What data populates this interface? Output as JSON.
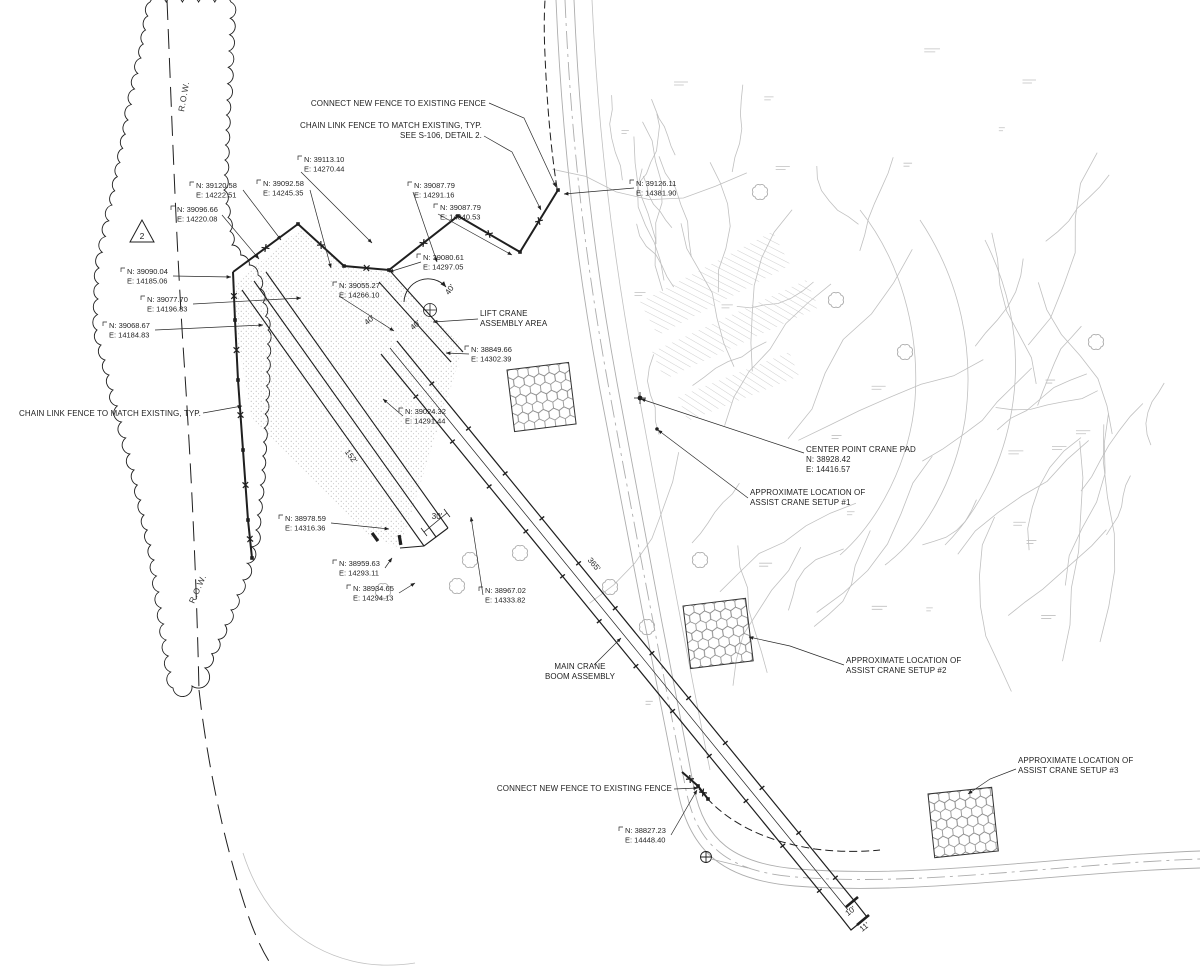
{
  "labels": {
    "connect_fence_top": "CONNECT NEW FENCE TO EXISTING FENCE",
    "chain_link_top_1": "CHAIN LINK FENCE TO MATCH EXISTING, TYP.",
    "chain_link_top_2": "SEE S-106, DETAIL 2.",
    "chain_link_left": "CHAIN LINK FENCE TO MATCH EXISTING, TYP.",
    "lift_crane_1": "LIFT CRANE",
    "lift_crane_2": "ASSEMBLY AREA",
    "center_pad_1": "CENTER POINT CRANE PAD",
    "center_pad_n": "N: 38928.42",
    "center_pad_e": "E: 14416.57",
    "assist_1_1": "APPROXIMATE LOCATION OF",
    "assist_1_2": "ASSIST CRANE SETUP #1",
    "assist_2_1": "APPROXIMATE LOCATION OF",
    "assist_2_2": "ASSIST CRANE SETUP #2",
    "assist_3_1": "APPROXIMATE LOCATION OF",
    "assist_3_2": "ASSIST CRANE SETUP #3",
    "main_crane_1": "MAIN CRANE",
    "main_crane_2": "BOOM ASSEMBLY",
    "connect_fence_bottom": "CONNECT NEW FENCE TO EXISTING FENCE",
    "row": "R.O.W.",
    "revision_triangle": "2"
  },
  "points": [
    {
      "n": "N: 39113.10",
      "e": "E: 14270.44"
    },
    {
      "n": "N: 39120.58",
      "e": "E: 14222.51"
    },
    {
      "n": "N: 39092.58",
      "e": "E: 14245.35"
    },
    {
      "n": "N: 39096.66",
      "e": "E: 14220.08"
    },
    {
      "n": "N: 39090.04",
      "e": "E: 14185.06"
    },
    {
      "n": "N: 39077.70",
      "e": "E: 14196.83"
    },
    {
      "n": "N: 39068.67",
      "e": "E: 14184.83"
    },
    {
      "n": "N: 39087.79",
      "e": "E: 14291.16"
    },
    {
      "n": "N: 39087.79",
      "e": "E: 14340.53"
    },
    {
      "n": "N: 39080.61",
      "e": "E: 14297.05"
    },
    {
      "n": "N: 39055.27",
      "e": "E: 14266.10"
    },
    {
      "n": "N: 39126.11",
      "e": "E: 14381.90"
    },
    {
      "n": "N: 38849.66",
      "e": "E: 14302.39"
    },
    {
      "n": "N: 39024.32",
      "e": "E: 14291.44"
    },
    {
      "n": "N: 38978.59",
      "e": "E: 14316.36"
    },
    {
      "n": "N: 38959.63",
      "e": "E: 14293.11"
    },
    {
      "n": "N: 38934.65",
      "e": "E: 14294.13"
    },
    {
      "n": "N: 38967.02",
      "e": "E: 14333.82"
    },
    {
      "n": "N: 38827.23",
      "e": "E: 14448.40"
    }
  ],
  "dimensions": {
    "pad_length": "152'",
    "pad_gap": "30'",
    "boom_length": "365'",
    "width_a": "40'",
    "width_b": "40'",
    "arc": "40'",
    "tip_a": "10'",
    "tip_b": "11'"
  }
}
